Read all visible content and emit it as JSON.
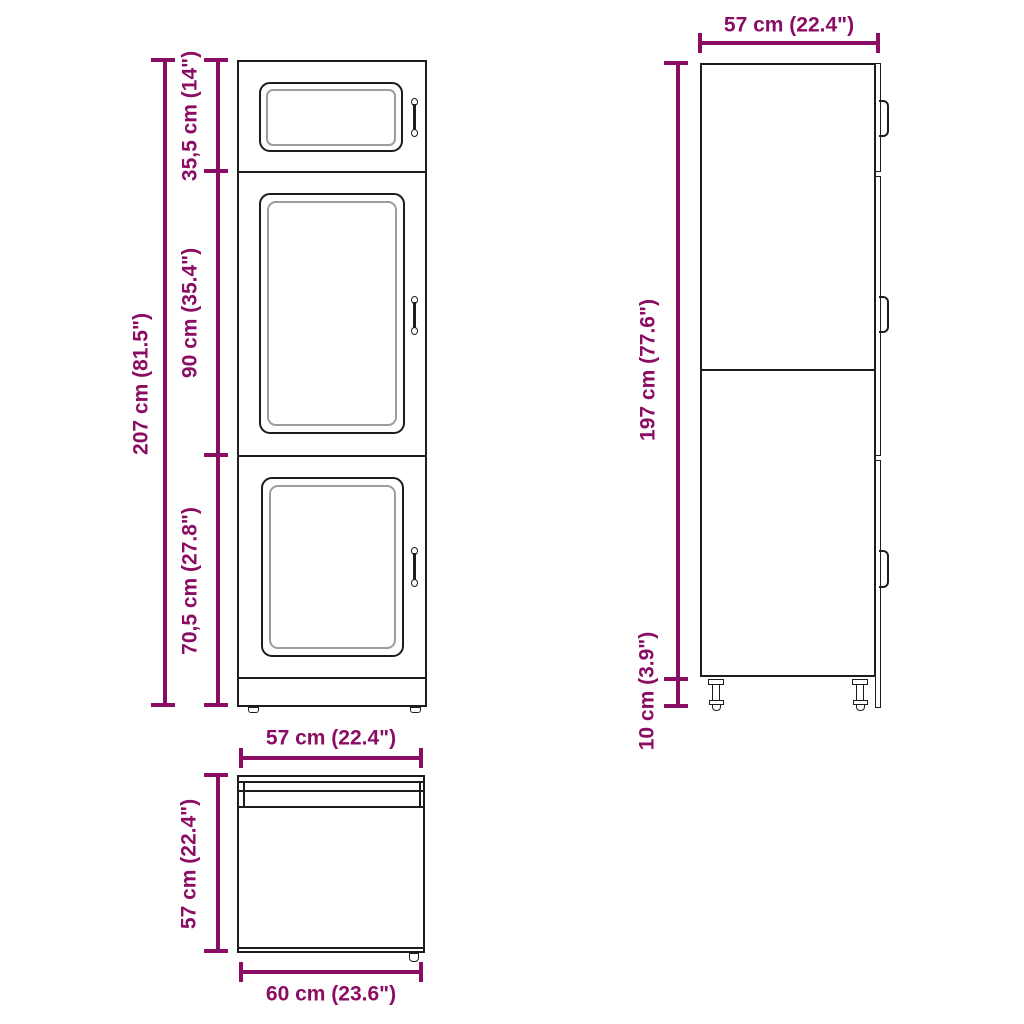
{
  "colors": {
    "dimension": "#8b0c63",
    "line": "#1d1d1b",
    "inner_line": "#9d9d9c",
    "background": "#ffffff"
  },
  "front_view": {
    "total_height_label": "207 cm (81.5\")",
    "section_labels": [
      "35,5 cm (14\")",
      "90 cm (35.4\")",
      "70,5 cm (27.8\")"
    ]
  },
  "side_view": {
    "width_label": "57 cm (22.4\")",
    "height_label": "197 cm (77.6\")",
    "legs_label": "10 cm (3.9\")"
  },
  "top_view": {
    "top_label": "57 cm (22.4\")",
    "left_label": "57 cm (22.4\")",
    "bottom_label": "60 cm (23.6\")"
  }
}
